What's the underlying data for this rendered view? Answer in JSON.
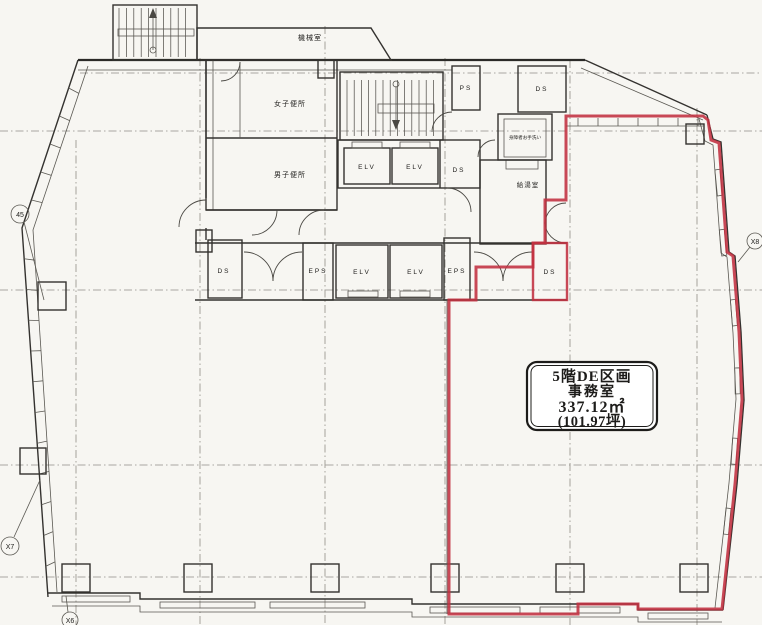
{
  "floor_plan": {
    "title_box": {
      "line1": "5階DE区画",
      "line2": "事務室",
      "line3": "337.12㎡",
      "line4": "(101.97坪)"
    },
    "rooms": {
      "machine_room": "機械室",
      "womens_toilet": "女子便所",
      "mens_toilet": "男子便所",
      "elv_upper_1": "ELV",
      "elv_upper_2": "ELV",
      "elv_lower_1": "ELV",
      "elv_lower_2": "ELV",
      "ps": "PS",
      "ds_top_right": "DS",
      "ds_upper_mid": "DS",
      "ds_lower_left": "DS",
      "ds_lower_right": "DS",
      "eps_lower_left": "EPS",
      "eps_lower_right": "EPS",
      "kitchenette": "給湯室",
      "accessible_toilet": "身障者お手洗い"
    },
    "grid_bubbles": {
      "top_left": "45",
      "bottom_left": "X7",
      "bottom": "X6",
      "right": "X8"
    },
    "colors": {
      "boundary_red": "#c23040",
      "wall": "#34322f",
      "grid": "#8f8d86",
      "paper": "#f7f6f2"
    }
  }
}
